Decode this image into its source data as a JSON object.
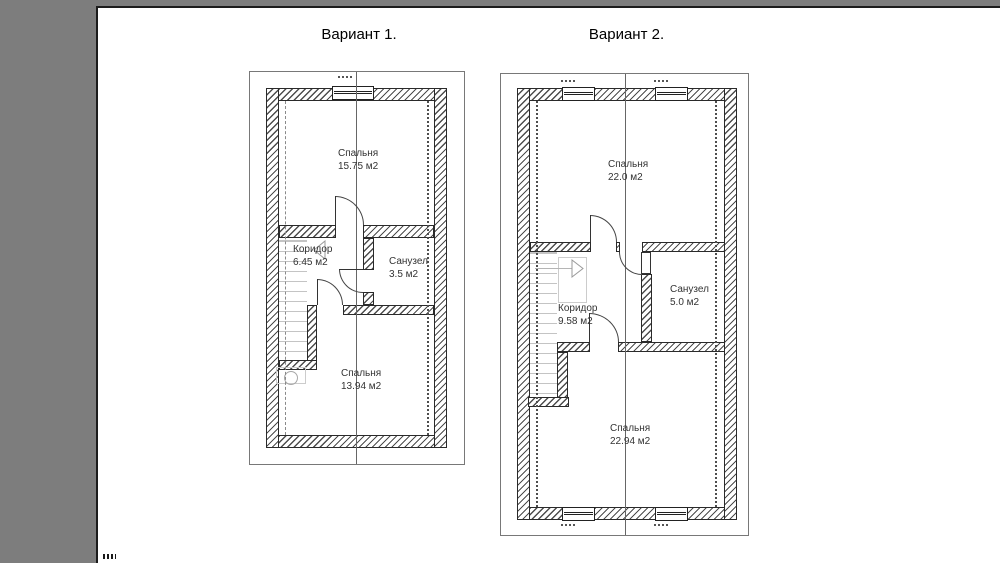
{
  "document": {
    "kind": "floor-plan-drawing"
  },
  "colors": {
    "canvas_bg": "#7d7d7d",
    "paper": "#ffffff",
    "drawing_line": "#333333",
    "hatch": "#4d4d4d"
  },
  "variants": [
    {
      "title": "Вариант 1.",
      "rooms": [
        {
          "name": "Спальня",
          "area": "15.75 м2"
        },
        {
          "name": "Коридор",
          "area": "6.45 м2"
        },
        {
          "name": "Санузел",
          "area": "3.5 м2"
        },
        {
          "name": "Спальня",
          "area": "13.94 м2"
        }
      ]
    },
    {
      "title": "Вариант 2.",
      "rooms": [
        {
          "name": "Спальня",
          "area": "22.0 м2"
        },
        {
          "name": "Санузел",
          "area": "5.0 м2"
        },
        {
          "name": "Коридор",
          "area": "9.58 м2"
        },
        {
          "name": "Спальня",
          "area": "22.94 м2"
        }
      ]
    }
  ]
}
